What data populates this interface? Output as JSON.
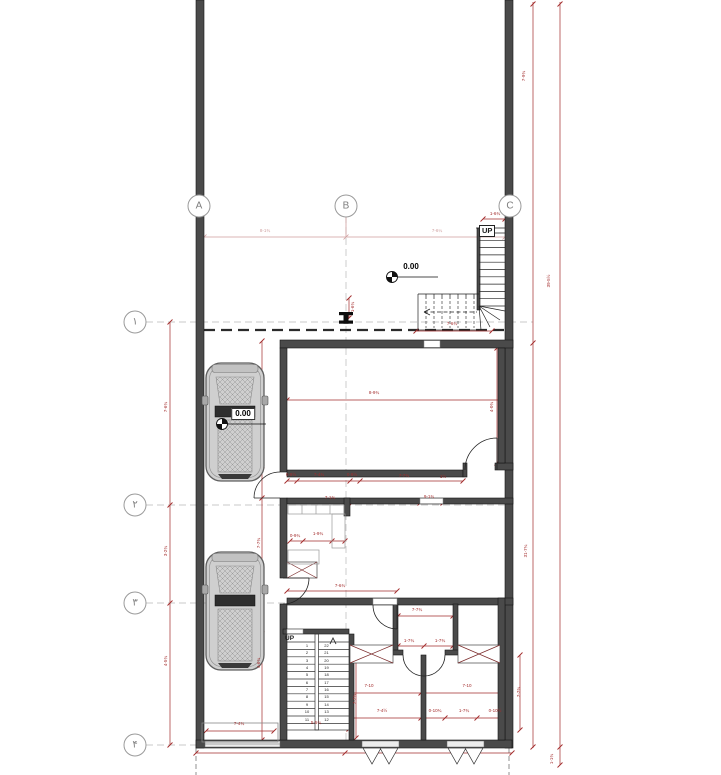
{
  "drawing": {
    "kind": "ground-floor plan with parking and stairs"
  },
  "grid": {
    "top": [
      {
        "label": "A"
      },
      {
        "label": "B"
      },
      {
        "label": "C"
      }
    ],
    "left": [
      {
        "label": "۱"
      },
      {
        "label": "۲"
      },
      {
        "label": "۳"
      },
      {
        "label": "۴"
      }
    ]
  },
  "levels": {
    "entry": "0.00",
    "garage": "0.00"
  },
  "stairs": {
    "top": {
      "up_label": "UP"
    },
    "bottom": {
      "up_label": "UP",
      "left_numbers": [
        "1",
        "2",
        "3",
        "4",
        "5",
        "6",
        "7",
        "8",
        "9",
        "10",
        "11"
      ],
      "right_numbers": [
        "22",
        "21",
        "20",
        "19",
        "18",
        "17",
        "16",
        "15",
        "14",
        "13",
        "12"
      ]
    }
  },
  "colors": {
    "wall": "#4a4a4a",
    "wall_edge": "#141414",
    "dim_red": "#a32c2c",
    "dim_pink": "#cf9f9f",
    "grid_gray": "#b9b9b9"
  },
  "dim_labels": [
    {
      "x": 265,
      "y": 231,
      "t": "8-1¾",
      "pink": true
    },
    {
      "x": 437,
      "y": 231,
      "t": "7-6¼",
      "pink": true
    },
    {
      "x": 495,
      "y": 214,
      "t": "1-6¾"
    },
    {
      "x": 452,
      "y": 324,
      "t": "7-6¾"
    },
    {
      "x": 374,
      "y": 393,
      "t": "8-9¾"
    },
    {
      "x": 492,
      "y": 407,
      "t": "4-0¾",
      "rot": true
    },
    {
      "x": 353,
      "y": 307,
      "t": "1-6¾",
      "rot": true
    },
    {
      "x": 524,
      "y": 76,
      "t": "7-9¾",
      "rot": true
    },
    {
      "x": 526,
      "y": 551,
      "t": "31-7¾",
      "rot": true
    },
    {
      "x": 549,
      "y": 281,
      "t": "39-5½",
      "rot": true
    },
    {
      "x": 552,
      "y": 759,
      "t": "1-1¾",
      "rot": true
    },
    {
      "x": 166,
      "y": 407,
      "t": "7-6¾",
      "rot": true
    },
    {
      "x": 166,
      "y": 551,
      "t": "3-2¾",
      "rot": true
    },
    {
      "x": 166,
      "y": 661,
      "t": "4-5¾",
      "rot": true
    },
    {
      "x": 259,
      "y": 543,
      "t": "7-7¾",
      "rot": true
    },
    {
      "x": 259,
      "y": 663,
      "t": "4-6¾",
      "rot": true
    },
    {
      "x": 291,
      "y": 475,
      "t": "0-9½"
    },
    {
      "x": 319,
      "y": 475,
      "t": "7-4¾"
    },
    {
      "x": 352,
      "y": 475,
      "t": "0-9½"
    },
    {
      "x": 404,
      "y": 476,
      "t": "7-7¾"
    },
    {
      "x": 443,
      "y": 477,
      "t": "1½"
    },
    {
      "x": 330,
      "y": 498,
      "t": "7-1¾"
    },
    {
      "x": 429,
      "y": 497,
      "t": "9-1¾"
    },
    {
      "x": 318,
      "y": 534,
      "t": "1-9¾"
    },
    {
      "x": 295,
      "y": 536,
      "t": "0-9¾"
    },
    {
      "x": 340,
      "y": 586,
      "t": "7-6¾"
    },
    {
      "x": 417,
      "y": 610,
      "t": "7-7¾"
    },
    {
      "x": 409,
      "y": 641,
      "t": "1-7¾"
    },
    {
      "x": 440,
      "y": 641,
      "t": "1-7¾"
    },
    {
      "x": 369,
      "y": 686,
      "t": "7-10"
    },
    {
      "x": 467,
      "y": 686,
      "t": "7-10"
    },
    {
      "x": 382,
      "y": 711,
      "t": "7-4½"
    },
    {
      "x": 435,
      "y": 711,
      "t": "0-10¾"
    },
    {
      "x": 464,
      "y": 711,
      "t": "1-7¾"
    },
    {
      "x": 495,
      "y": 711,
      "t": "0-10½"
    },
    {
      "x": 355,
      "y": 699,
      "t": "7-7¾",
      "rot": true
    },
    {
      "x": 316,
      "y": 723,
      "t": "5-5¾"
    },
    {
      "x": 239,
      "y": 724,
      "t": "7-4¾"
    },
    {
      "x": 519,
      "y": 692,
      "t": "7-7¾",
      "rot": true
    }
  ]
}
